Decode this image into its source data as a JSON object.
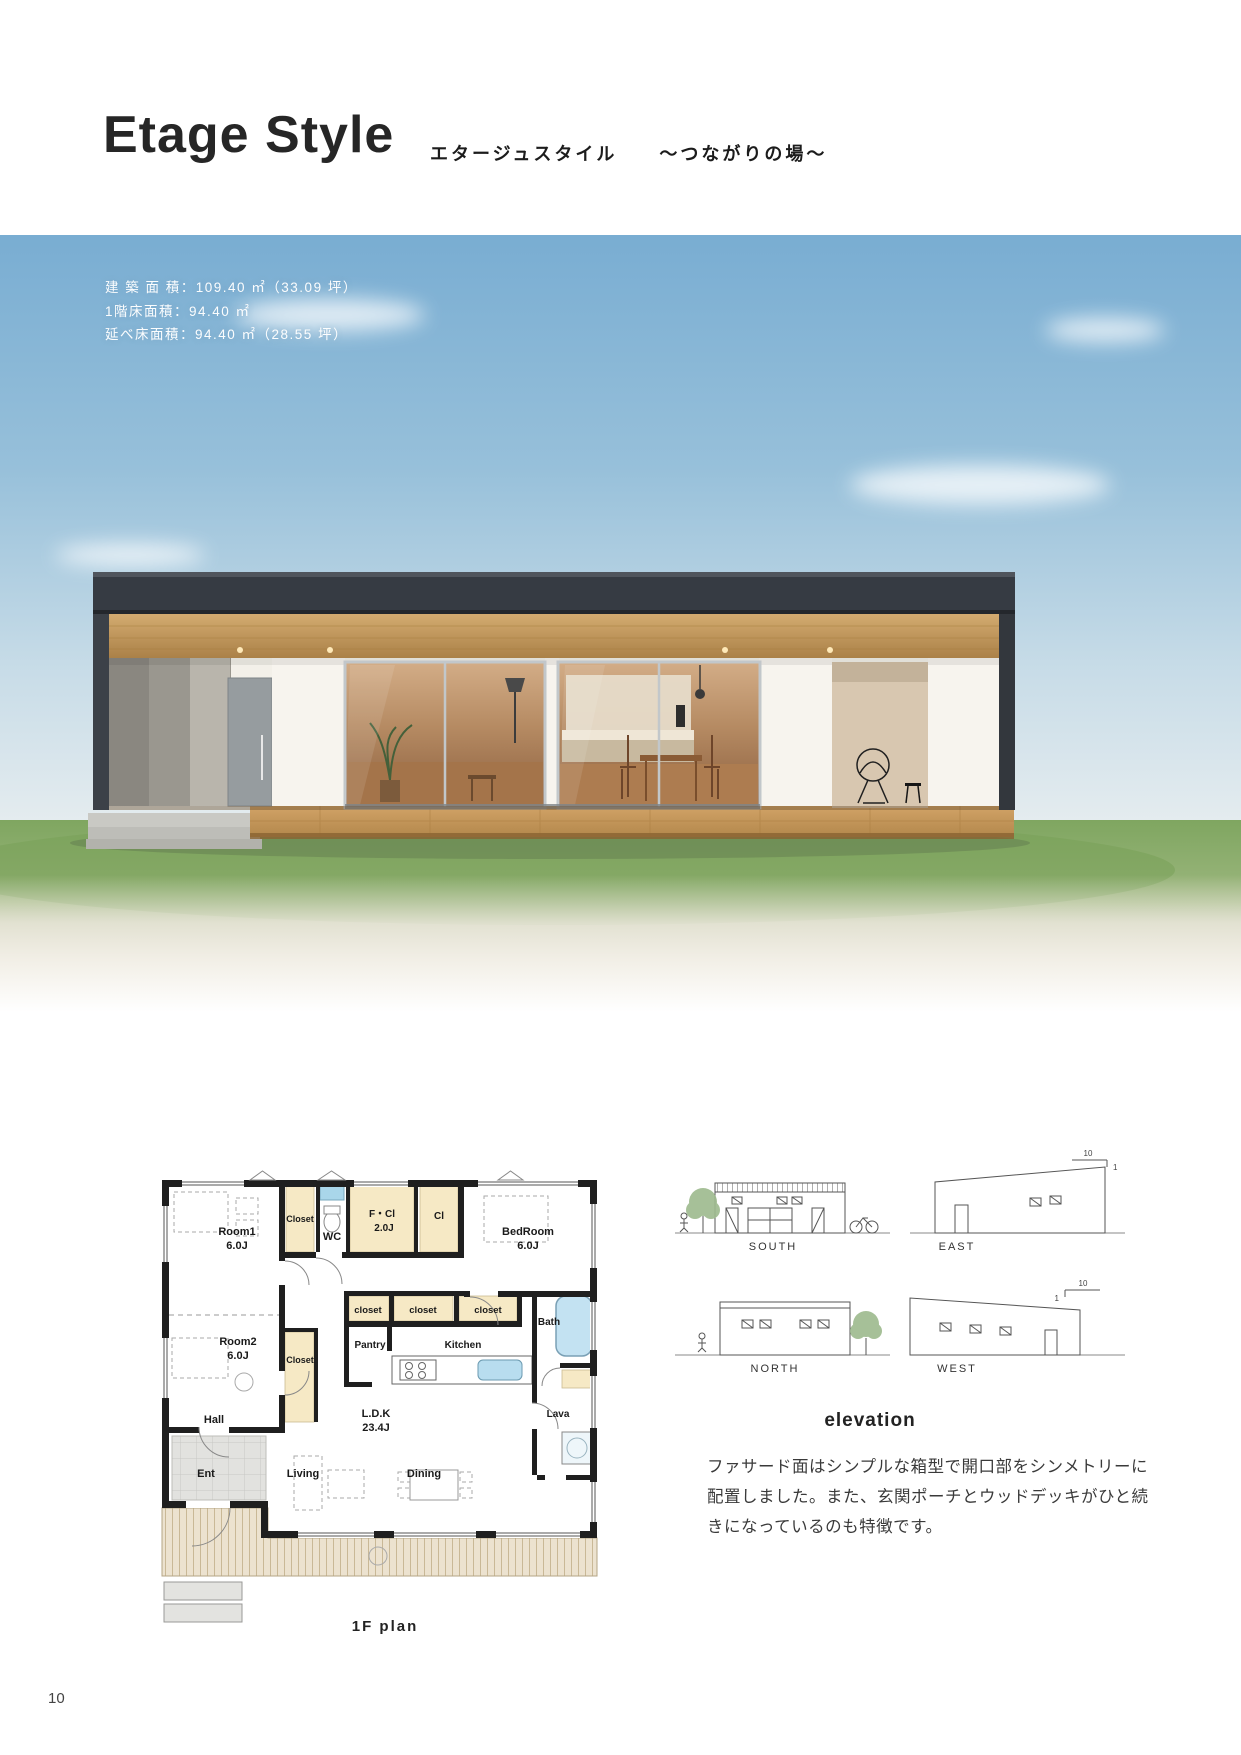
{
  "header": {
    "title": "Etage Style",
    "subtitle": "エタージュスタイル",
    "tagline": "〜つながりの場〜"
  },
  "photo": {
    "spec_lines": [
      "建 築 面 積：109.40 ㎡（33.09 坪）",
      "1階床面積：94.40 ㎡",
      "延べ床面積：94.40 ㎡（28.55 坪）"
    ]
  },
  "floor_plan": {
    "caption": "1F plan",
    "labels": {
      "room1": "Room1",
      "room1_size": "6.0J",
      "closet1": "Closet",
      "wc": "WC",
      "fcl": "F・Cl",
      "fcl_size": "2.0J",
      "cl": "Cl",
      "bedroom": "BedRoom",
      "bedroom_size": "6.0J",
      "room2": "Room2",
      "room2_size": "6.0J",
      "closet2": "Closet",
      "closet_a": "closet",
      "closet_b": "closet",
      "closet_c": "closet",
      "pantry": "Pantry",
      "kitchen": "Kitchen",
      "bath": "Bath",
      "lava": "Lava",
      "hall": "Hall",
      "ent": "Ent",
      "living": "Living",
      "dining": "Dining",
      "ldk": "L.D.K",
      "ldk_size": "23.4J"
    }
  },
  "elevations": {
    "caption": "elevation",
    "south": "SOUTH",
    "east": "EAST",
    "north": "NORTH",
    "west": "WEST",
    "slope_top": "10",
    "slope_side": "1",
    "description_lines": [
      "ファサード面はシンプルな箱型で開口部をシンメトリーに",
      "配置しました。また、玄関ポーチとウッドデッキがひと続",
      "きになっているのも特徴です。"
    ]
  },
  "footer": {
    "page_number": "10"
  }
}
